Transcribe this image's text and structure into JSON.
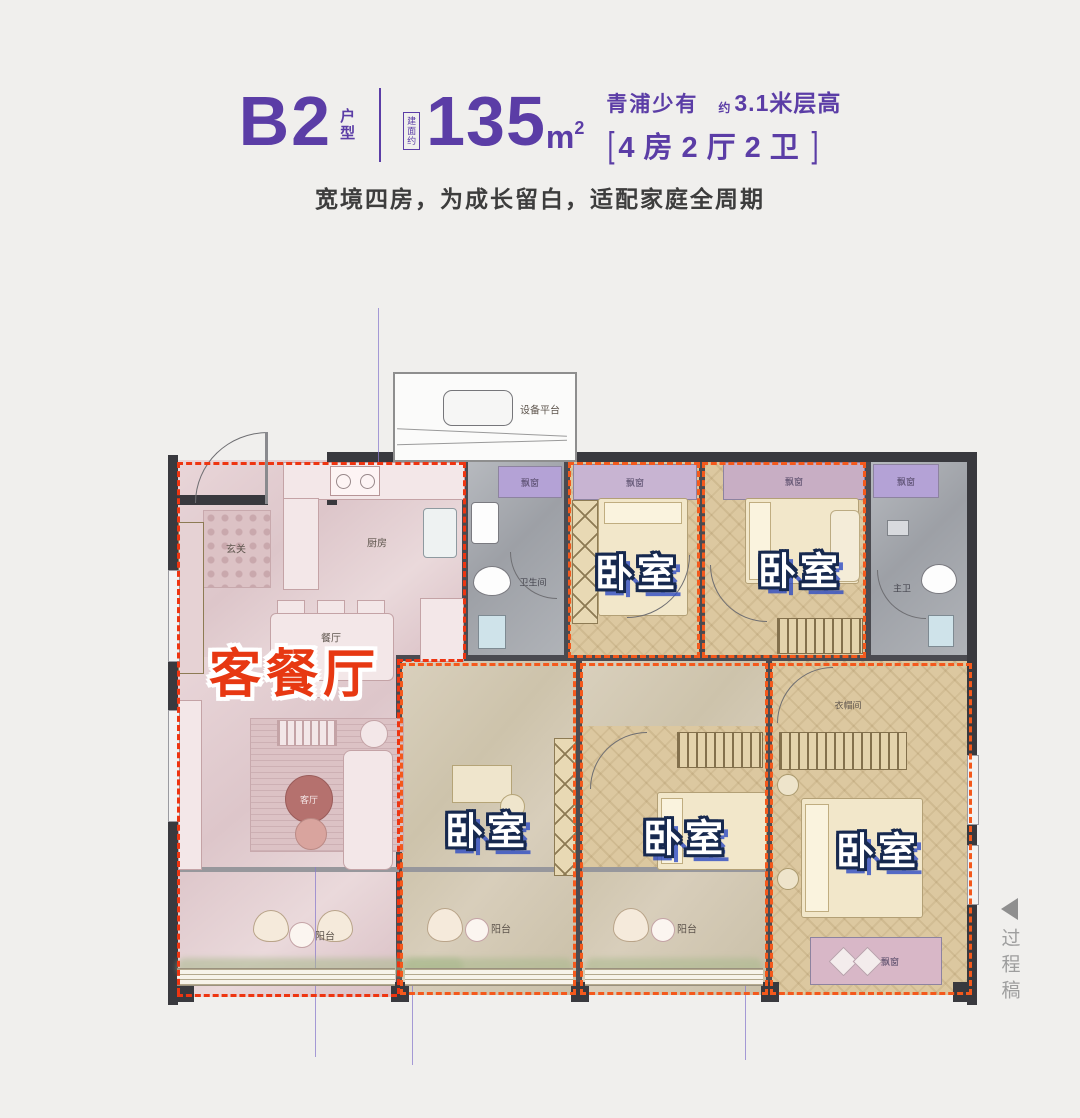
{
  "header": {
    "plan_code": "B2",
    "plan_code_tag": "户型",
    "area_note": "建面约",
    "area_value": "135",
    "area_unit": "m",
    "area_sup": "2",
    "highlight": "青浦少有",
    "height_prefix": "约",
    "height_text": "3.1米层高",
    "bracket_open": "[",
    "layout_spec": "4房2厅2卫",
    "bracket_close": "]",
    "subtitle": "宽境四房，为成长留白，适配家庭全周期",
    "accent_color": "#5b3da6"
  },
  "plan": {
    "equipment_platform": "设备平台",
    "living_dining_big": "客餐厅",
    "bedroom_big": "卧室",
    "entry": "玄关",
    "kitchen": "厨房",
    "dining": "餐厅",
    "living": "客厅",
    "balcony": "阳台",
    "bathroom": "卫生间",
    "master_bathroom": "主卫",
    "bay_window": "飘窗",
    "closet": "衣帽间",
    "living_label_color": "#e73812",
    "bedroom_outline_color": "#17294f",
    "dash_red": "#ee3511",
    "dash_orange": "#f4591c"
  },
  "watermark": {
    "arrow_icon": "left-triangle",
    "text": "过程稿",
    "color": "#9e9e9e"
  }
}
